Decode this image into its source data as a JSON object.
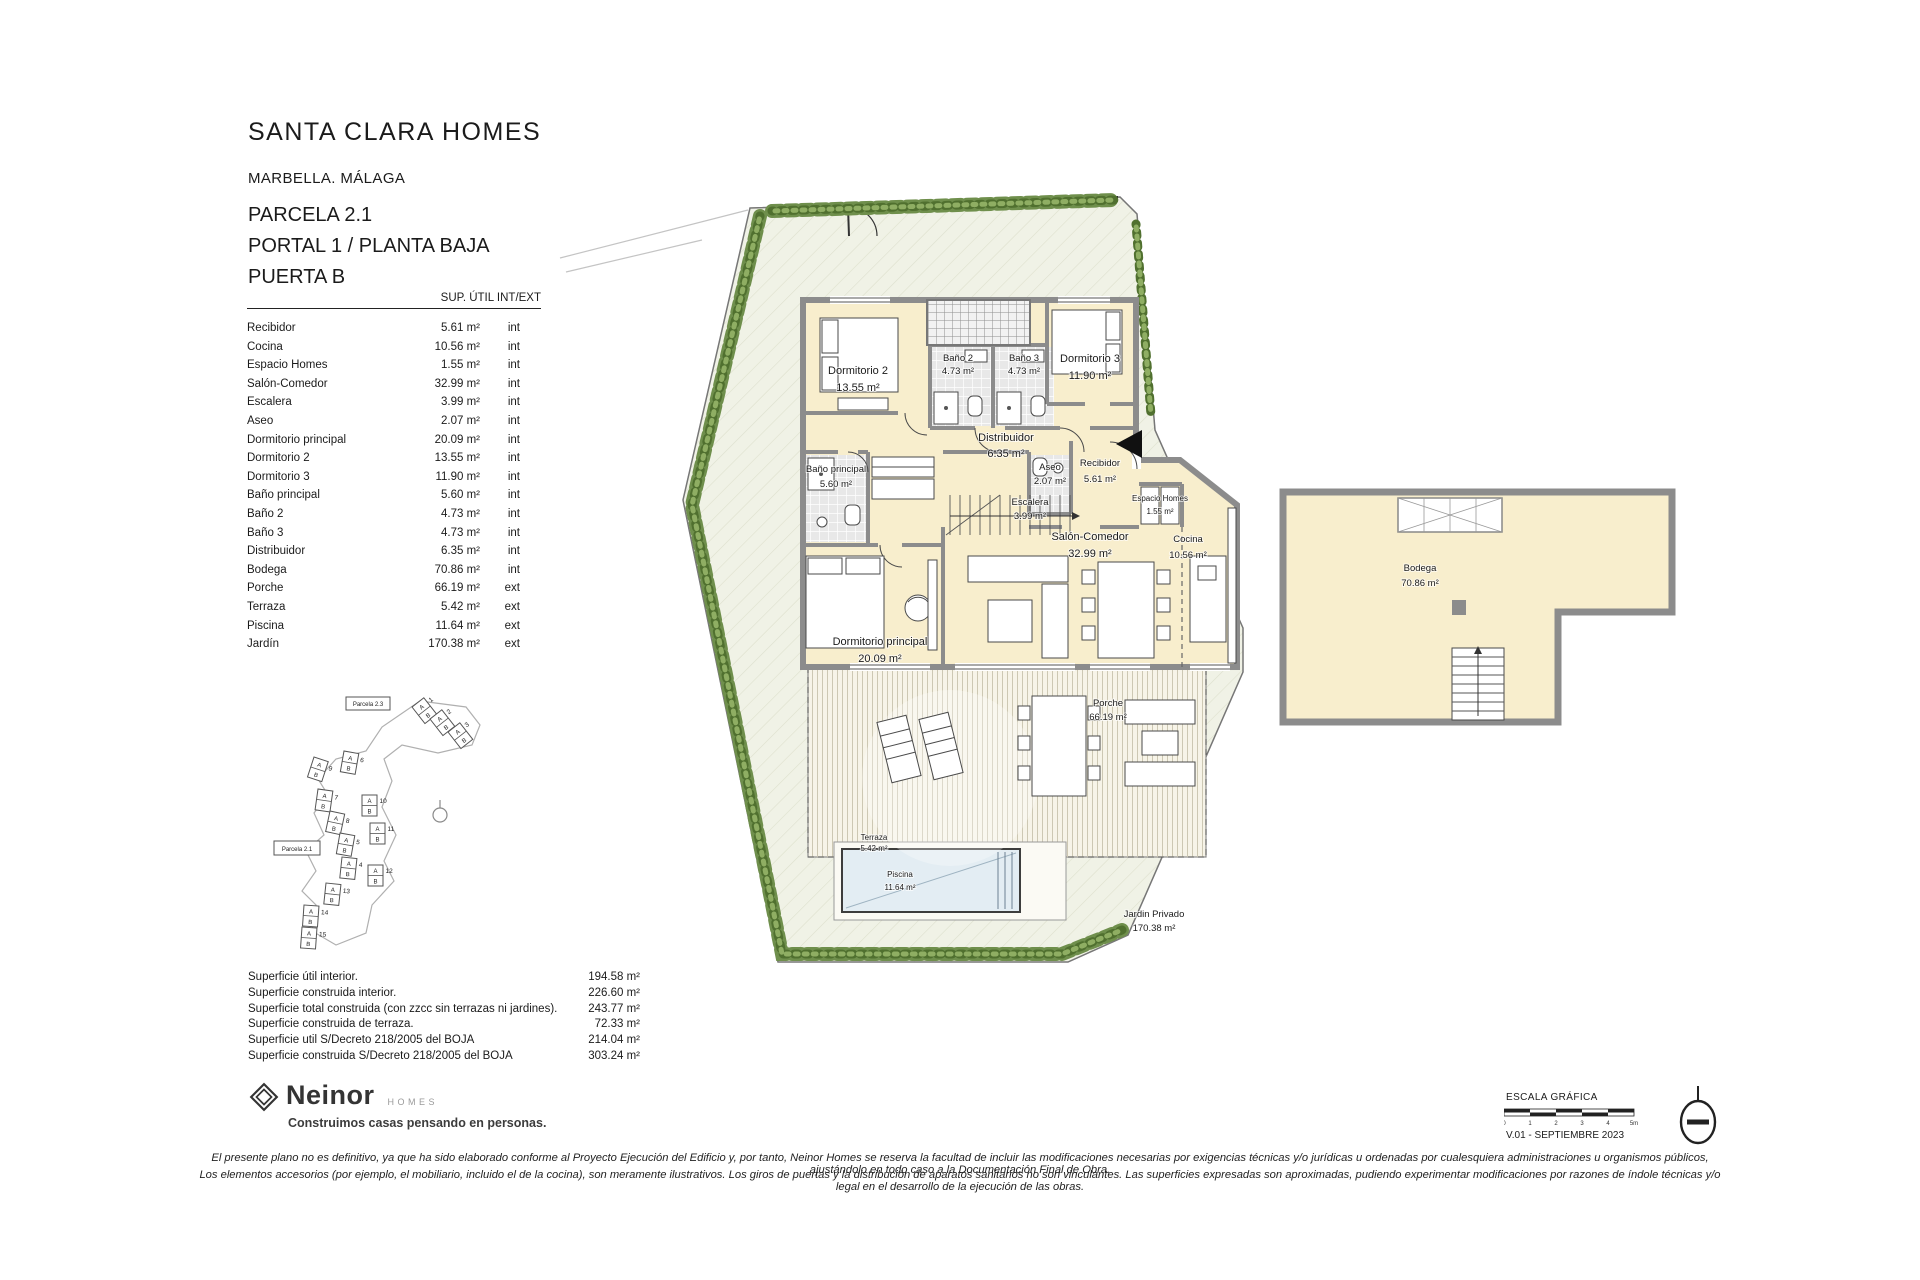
{
  "header": {
    "project": "SANTA CLARA HOMES",
    "location": "MARBELLA. MÁLAGA",
    "parcel": "PARCELA 2.1",
    "portal": "PORTAL 1 / PLANTA BAJA",
    "door": "PUERTA B",
    "table_header": "SUP. ÚTIL INT/EXT"
  },
  "rooms": [
    {
      "name": "Recibidor",
      "area": "5.61 m²",
      "type": "int"
    },
    {
      "name": "Cocina",
      "area": "10.56 m²",
      "type": "int"
    },
    {
      "name": "Espacio Homes",
      "area": "1.55 m²",
      "type": "int"
    },
    {
      "name": "Salón-Comedor",
      "area": "32.99 m²",
      "type": "int"
    },
    {
      "name": "Escalera",
      "area": "3.99 m²",
      "type": "int"
    },
    {
      "name": "Aseo",
      "area": "2.07 m²",
      "type": "int"
    },
    {
      "name": "Dormitorio principal",
      "area": "20.09 m²",
      "type": "int"
    },
    {
      "name": "Dormitorio 2",
      "area": "13.55 m²",
      "type": "int"
    },
    {
      "name": "Dormitorio 3",
      "area": "11.90 m²",
      "type": "int"
    },
    {
      "name": "Baño principal",
      "area": "5.60 m²",
      "type": "int"
    },
    {
      "name": "Baño 2",
      "area": "4.73 m²",
      "type": "int"
    },
    {
      "name": "Baño 3",
      "area": "4.73 m²",
      "type": "int"
    },
    {
      "name": "Distribuidor",
      "area": "6.35 m²",
      "type": "int"
    },
    {
      "name": "Bodega",
      "area": "70.86 m²",
      "type": "int"
    },
    {
      "name": "Porche",
      "area": "66.19 m²",
      "type": "ext"
    },
    {
      "name": "Terraza",
      "area": "5.42 m²",
      "type": "ext"
    },
    {
      "name": "Piscina",
      "area": "11.64 m²",
      "type": "ext"
    },
    {
      "name": "Jardín",
      "area": "170.38 m²",
      "type": "ext"
    }
  ],
  "summary": [
    {
      "label": "Superficie útil interior.",
      "value": "194.58 m²"
    },
    {
      "label": "Superficie construida interior.",
      "value": "226.60 m²"
    },
    {
      "label": "Superficie total construida (con zzcc sin terrazas ni jardines).",
      "value": "243.77 m²"
    },
    {
      "label": "Superficie construida de terraza.",
      "value": "72.33 m²"
    },
    {
      "label": "Superficie util S/Decreto 218/2005 del BOJA",
      "value": "214.04 m²"
    },
    {
      "label": "Superficie construida S/Decreto 218/2005 del BOJA",
      "value": "303.24 m²"
    }
  ],
  "plan": {
    "rooms": {
      "dormitorio2": {
        "name": "Dormitorio 2",
        "area": "13.55 m²"
      },
      "bano2": {
        "name": "Baño 2",
        "area": "4.73 m²"
      },
      "bano3": {
        "name": "Baño 3",
        "area": "4.73 m²"
      },
      "dormitorio3": {
        "name": "Dormitorio 3",
        "area": "11.90 m²"
      },
      "distribuidor": {
        "name": "Distribuidor",
        "area": "6.35 m²"
      },
      "banoprincipal": {
        "name": "Baño principal",
        "area": "5.60 m²"
      },
      "aseo": {
        "name": "Aseo",
        "area": "2.07 m²"
      },
      "recibidor": {
        "name": "Recibidor",
        "area": "5.61 m²"
      },
      "espacio": {
        "name": "Espacio Homes",
        "area": "1.55 m²"
      },
      "escalera": {
        "name": "Escalera",
        "area": "3.99 m²"
      },
      "salon": {
        "name": "Salón-Comedor",
        "area": "32.99 m²"
      },
      "cocina": {
        "name": "Cocina",
        "area": "10.56 m²"
      },
      "dormprincipal": {
        "name": "Dormitorio principal",
        "area": "20.09 m²"
      },
      "porche": {
        "name": "Porche",
        "area": "66.19 m²"
      },
      "terraza": {
        "name": "Terraza",
        "area": "5.42 m²"
      },
      "piscina": {
        "name": "Piscina",
        "area": "11.64 m²"
      },
      "jardin": {
        "name": "Jardin Privado",
        "area": "170.38 m²"
      },
      "bodega": {
        "name": "Bodega",
        "area": "70.86 m²"
      }
    }
  },
  "site_plan": {
    "parcels": [
      "Parcela 2.3",
      "Parcela 2.1"
    ],
    "unit_letters": [
      "A",
      "B"
    ],
    "unit_numbers": [
      "1",
      "2",
      "3",
      "9",
      "6",
      "7",
      "8",
      "10",
      "11",
      "5",
      "4",
      "12",
      "13",
      "14",
      "15"
    ]
  },
  "footer": {
    "logo_name": "Neinor",
    "logo_sub": "HOMES",
    "tagline": "Construimos casas pensando en personas.",
    "scale_label": "ESCALA GRÁFICA",
    "scale_ticks": [
      "0",
      "1",
      "2",
      "3",
      "4",
      "5m"
    ],
    "version": "V.01 - SEPTIEMBRE 2023",
    "disclaimer_line1": "El presente plano no es definitivo, ya que ha sido elaborado conforme al Proyecto Ejecución del Edificio y, por tanto, Neinor Homes se reserva la facultad de incluir las modificaciones necesarias por exigencias técnicas y/o jurídicas u ordenadas por cualesquiera administraciones u organismos públicos, ajustándolo en todo caso a la Documentación Final de Obra.",
    "disclaimer_line2": "Los elementos accesorios (por ejemplo, el mobiliario, incluido el de la cocina), son meramente ilustrativos. Los giros de puertas y la distribución de aparatos sanitarios no son vinculantes. Las superficies expresadas son aproximadas, pudiendo experimentar modificaciones por razones de índole técnicas y/o legal en el desarrollo de la ejecución de las obras."
  }
}
